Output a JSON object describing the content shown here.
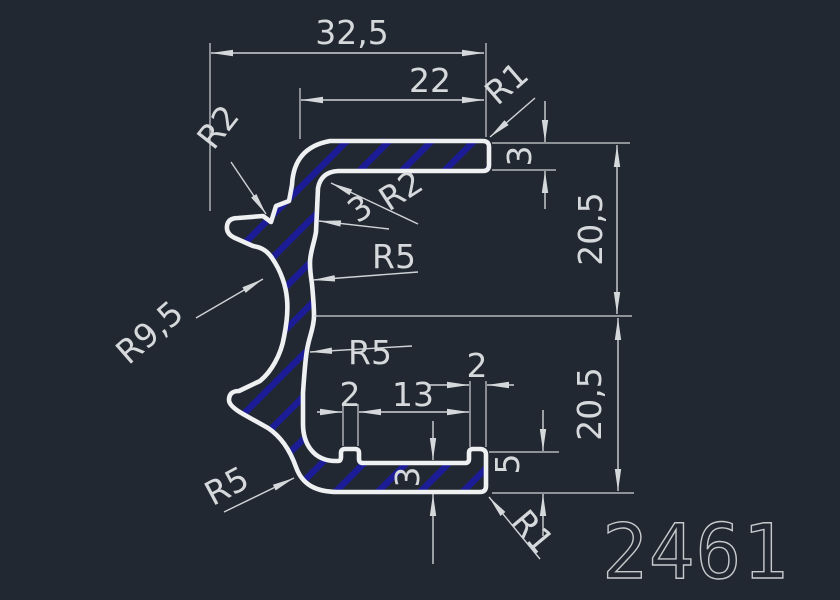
{
  "drawing": {
    "number": "2461",
    "background_color": "#222831",
    "outline_color": "#eef0f2",
    "dimension_color": "#cfd3d7",
    "hatch_color": "#1c1c96"
  },
  "dimensions": {
    "overall_width": "32,5",
    "flange_width": "22",
    "top_corner_radius": "R1",
    "flange_thickness": "3",
    "upper_height": "20,5",
    "lower_height": "20,5",
    "left_corner_radius": "R2",
    "inner_corner_radius": "R2",
    "wall_thickness": "3",
    "upper_inner_radius": "R5",
    "left_concave_radius": "R9,5",
    "lower_inner_radius": "R5",
    "bottom_left_radius": "R5",
    "left_tab_width": "2",
    "groove_width": "13",
    "right_tab_width": "2",
    "groove_floor_thickness": "3",
    "right_wall_height": "5",
    "bottom_corner_radius": "R1"
  }
}
